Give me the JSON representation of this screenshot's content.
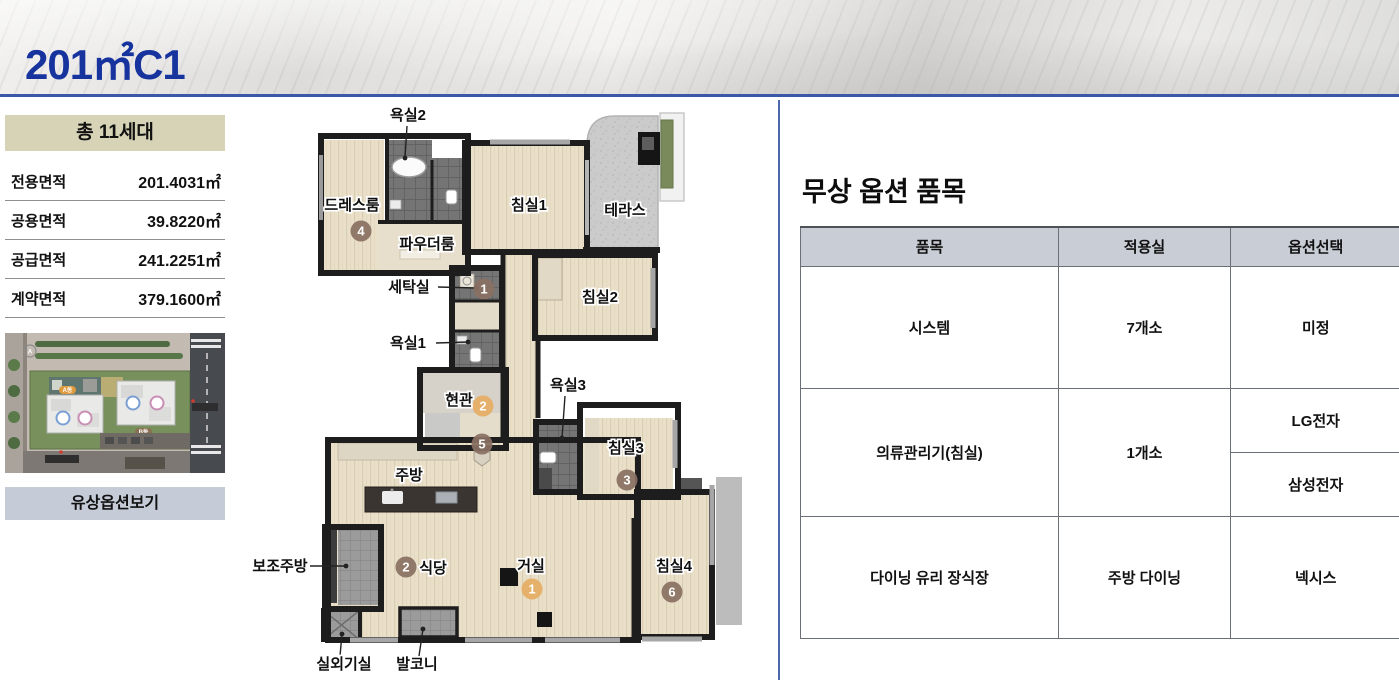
{
  "header": {
    "title": "201㎡C1",
    "accent_color": "#16339e",
    "line_color": "#3a57a8"
  },
  "sidebar": {
    "total_units": "총 11세대",
    "areas": [
      {
        "label": "전용면적",
        "value": "201.4031㎡"
      },
      {
        "label": "공용면적",
        "value": "39.8220㎡"
      },
      {
        "label": "공급면적",
        "value": "241.2251㎡"
      },
      {
        "label": "계약면적",
        "value": "379.1600㎡"
      }
    ],
    "site_plan": {
      "badge_a": "A동",
      "badge_b": "B동"
    },
    "paid_option_button": "유상옵션보기"
  },
  "floor_plan": {
    "marker_colors": {
      "brown": "#8a7163",
      "orange": "#e5ad64"
    },
    "labels": [
      {
        "text": "욕실2",
        "x": 158,
        "y": 20,
        "line": [
          157,
          26,
          155,
          58
        ]
      },
      {
        "text": "드레스룸",
        "x": 102,
        "y": 110
      },
      {
        "text": "파우더룸",
        "x": 177,
        "y": 149
      },
      {
        "text": "침실1",
        "x": 279,
        "y": 110
      },
      {
        "text": "테라스",
        "x": 375,
        "y": 115
      },
      {
        "text": "세탁실",
        "x": 159,
        "y": 192,
        "line": [
          188,
          187,
          226,
          188
        ]
      },
      {
        "text": "침실2",
        "x": 350,
        "y": 202
      },
      {
        "text": "욕실1",
        "x": 158,
        "y": 248,
        "line": [
          186,
          243,
          218,
          242
        ]
      },
      {
        "text": "현관",
        "x": 209,
        "y": 305
      },
      {
        "text": "욕실3",
        "x": 318,
        "y": 290,
        "line": [
          315,
          296,
          312,
          338
        ]
      },
      {
        "text": "침실3",
        "x": 376,
        "y": 353
      },
      {
        "text": "주방",
        "x": 159,
        "y": 380
      },
      {
        "text": "보조주방",
        "x": 30,
        "y": 471,
        "line": [
          60,
          466,
          96,
          466
        ]
      },
      {
        "text": "식당",
        "x": 183,
        "y": 473
      },
      {
        "text": "거실",
        "x": 281,
        "y": 471
      },
      {
        "text": "침실4",
        "x": 424,
        "y": 471
      },
      {
        "text": "실외기실",
        "x": 94,
        "y": 569,
        "line": [
          90,
          556,
          92,
          534
        ]
      },
      {
        "text": "발코니",
        "x": 167,
        "y": 569,
        "line": [
          169,
          556,
          173,
          529
        ]
      }
    ],
    "markers": [
      {
        "n": "1",
        "x": 234,
        "y": 189,
        "c": "brown"
      },
      {
        "n": "4",
        "x": 111,
        "y": 131,
        "c": "brown"
      },
      {
        "n": "2",
        "x": 233,
        "y": 306,
        "c": "orange"
      },
      {
        "n": "5",
        "x": 232,
        "y": 344,
        "c": "brown"
      },
      {
        "n": "2",
        "x": 156,
        "y": 467,
        "c": "brown"
      },
      {
        "n": "1",
        "x": 282,
        "y": 489,
        "c": "orange"
      },
      {
        "n": "3",
        "x": 377,
        "y": 380,
        "c": "brown"
      },
      {
        "n": "6",
        "x": 422,
        "y": 492,
        "c": "brown"
      }
    ]
  },
  "options": {
    "heading": "무상 옵션 품목",
    "columns": [
      "품목",
      "적용실",
      "옵션선택"
    ],
    "rows": [
      {
        "item": "시스템",
        "room": "7개소",
        "choices": [
          "미정"
        ]
      },
      {
        "item": "의류관리기(침실)",
        "room": "1개소",
        "choices": [
          "LG전자",
          "삼성전자"
        ]
      },
      {
        "item": "다이닝 유리 장식장",
        "room": "주방 다이닝",
        "choices": [
          "넥시스"
        ]
      }
    ]
  }
}
